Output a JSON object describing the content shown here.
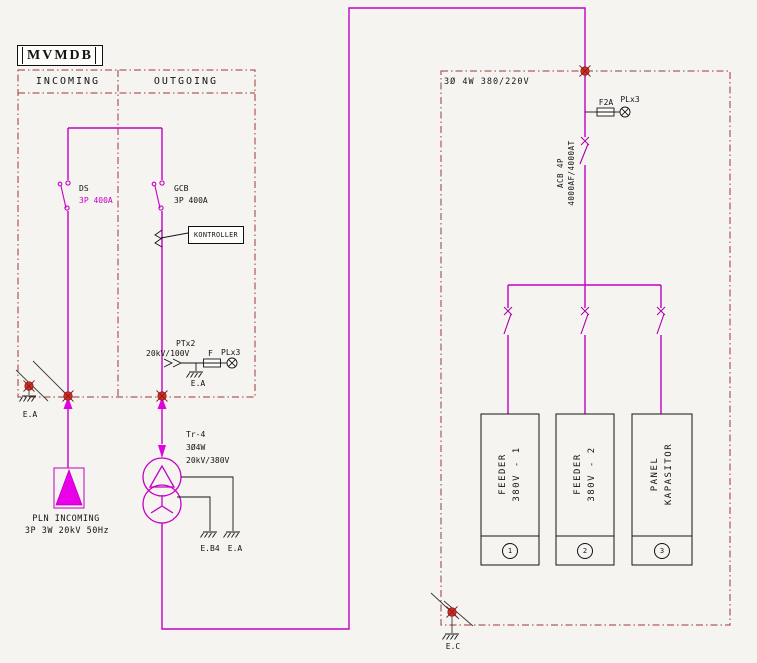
{
  "left": {
    "title": "MVMDB",
    "incoming": "INCOMING",
    "outgoing": "OUTGOING",
    "ds_name": "DS",
    "ds_rating": "3P 400A",
    "gcb_name": "GCB",
    "gcb_rating": "3P 400A",
    "kontroller": "KONTROLLER",
    "pt_name": "PTx2",
    "pt_ratio": "20kV/100V",
    "pt_fuse": "F",
    "pt_lamp": "PLx3",
    "pt_ground": "E.A",
    "corner_ground": "E.A",
    "source_line1": "PLN INCOMING",
    "source_line2": "3P 3W 20kV 50Hz"
  },
  "transformer": {
    "name": "Tr-4",
    "config": "3Ø4W",
    "ratio": "20kV/380V",
    "ground1": "E.B4",
    "ground2": "E.A"
  },
  "right": {
    "system": "3Ø 4W 380/220V",
    "fuse": "F2A",
    "lamp": "PLx3",
    "acb_line1": "ACB 4P",
    "acb_line2": "4000AF/4000AT",
    "corner_ground": "E.C",
    "feeders": [
      {
        "line1": "FEEDER",
        "line2": "380V - 1",
        "num": "1"
      },
      {
        "line1": "FEEDER",
        "line2": "380V - 2",
        "num": "2"
      },
      {
        "line1": "PANEL",
        "line2": "KAPASITOR",
        "num": "3"
      }
    ]
  },
  "colors": {
    "accent_magenta": "#c400c4",
    "frame_red": "#9a3838",
    "node_red": "#d63024",
    "text_black": "#141414"
  }
}
